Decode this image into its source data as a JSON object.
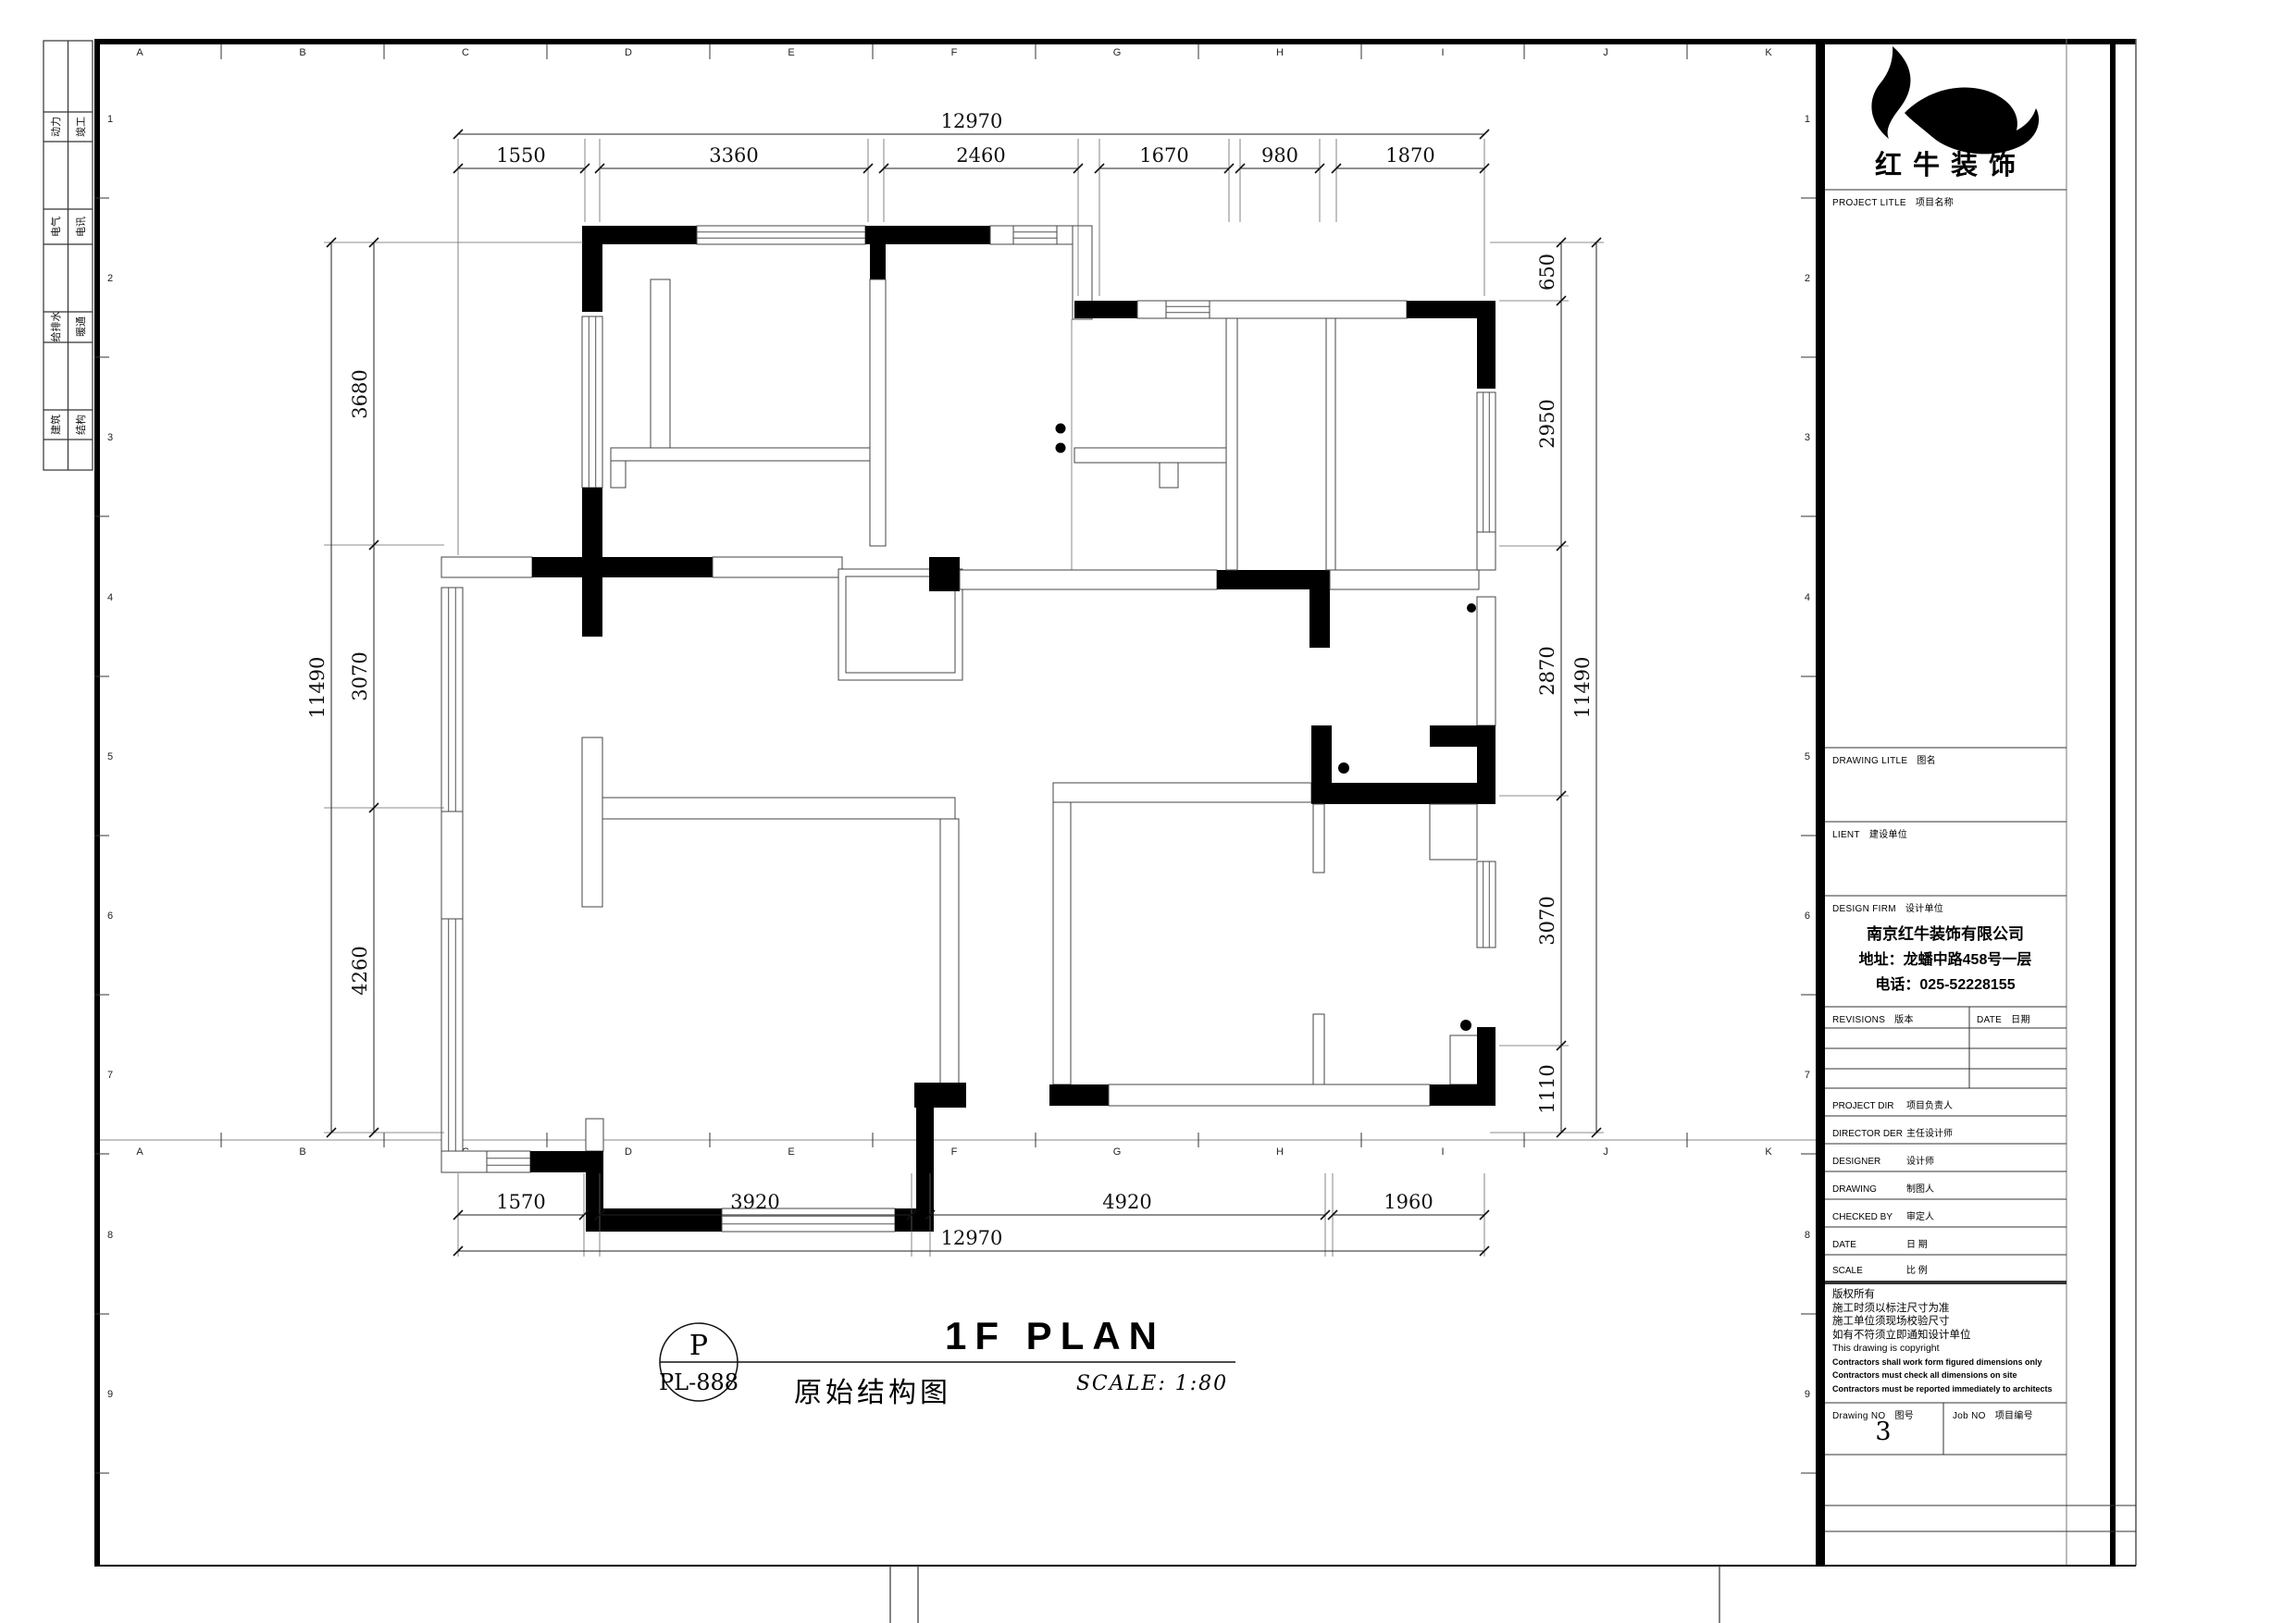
{
  "sheet": {
    "grid_letters": [
      "A",
      "B",
      "C",
      "D",
      "E",
      "F",
      "G",
      "H",
      "I",
      "J",
      "K"
    ],
    "grid_numbers": [
      "1",
      "2",
      "3",
      "4",
      "5",
      "6",
      "7",
      "8",
      "9"
    ],
    "tabs": [
      {
        "col1": "动力",
        "col2": "竣工"
      },
      {
        "col1": "电气",
        "col2": "电讯"
      },
      {
        "col1": "给排水",
        "col2": "暖通"
      },
      {
        "col1": "建筑",
        "col2": "结构"
      }
    ]
  },
  "dims": {
    "top": {
      "overall": "12970",
      "segments": [
        "1550",
        "3360",
        "2460",
        "1670",
        "980",
        "1870"
      ]
    },
    "bottom": {
      "overall": "12970",
      "segments": [
        "1570",
        "3920",
        "4920",
        "1960"
      ]
    },
    "left": {
      "overall": "11490",
      "segments": [
        "3680",
        "3070",
        "4260"
      ]
    },
    "right": {
      "overall": "11490",
      "segments": [
        "650",
        "2950",
        "2870",
        "3070",
        "1110"
      ]
    }
  },
  "title_area": {
    "badge_top": "P",
    "badge_bottom": "PL-888",
    "heading": "1F PLAN",
    "subheading": "原始结构图",
    "scale_note": "SCALE: 1:80"
  },
  "title_block": {
    "brand": "红牛装饰",
    "sections": {
      "project": {
        "en": "PROJECT LITLE",
        "zh": "项目名称"
      },
      "drawing": {
        "en": "DRAWING LITLE",
        "zh": "图名"
      },
      "client": {
        "en": "LIENT",
        "zh": "建设单位"
      },
      "firm": {
        "en": "DESIGN FIRM",
        "zh": "设计单位"
      }
    },
    "firm_info": {
      "name": "南京红牛装饰有限公司",
      "address": "地址：龙蟠中路458号一层",
      "phone": "电话：025-52228155"
    },
    "revisions": {
      "en": "REVISIONS",
      "zh": "版本"
    },
    "date_col": {
      "en": "DATE",
      "zh": "日期"
    },
    "roles": [
      {
        "en": "PROJECT DIR",
        "zh": "项目负责人"
      },
      {
        "en": "DIRECTOR DER",
        "zh": "主任设计师"
      },
      {
        "en": "DESIGNER",
        "zh": "设计师"
      },
      {
        "en": "DRAWING",
        "zh": "制图人"
      },
      {
        "en": "CHECKED BY",
        "zh": "审定人"
      },
      {
        "en": "DATE",
        "zh": "日  期"
      },
      {
        "en": "SCALE",
        "zh": "比  例"
      }
    ],
    "notes": [
      "版权所有",
      "施工时须以标注尺寸为准",
      "施工单位须现场校验尺寸",
      "如有不符须立即通知设计单位",
      "This drawing is copyright",
      "Contractors shall work form figured dimensions only",
      "Contractors must check all dimensions on site",
      "Contractors must be reported immediately to architects"
    ],
    "drawing_no": {
      "en": "Drawing NO",
      "zh": "图号",
      "value": "3"
    },
    "job_no": {
      "en": "Job NO",
      "zh": "项目编号"
    }
  }
}
